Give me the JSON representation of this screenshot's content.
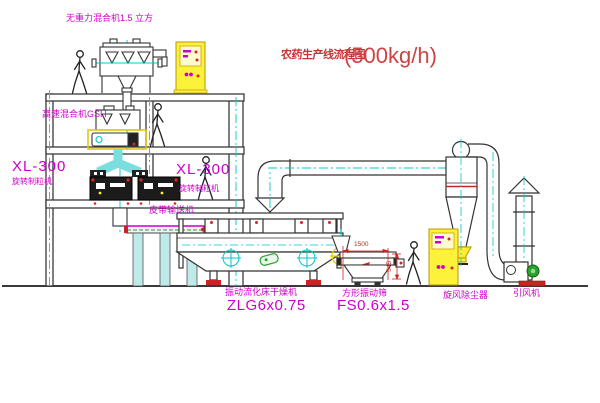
{
  "title": {
    "text": "农药生产线流程图",
    "capacity": "(500kg/h)"
  },
  "equipment_labels": {
    "gravity_mixer": "无重力混合机1.5 立方",
    "high_speed_mixer": "高速混合机GSH",
    "granulator_left_model": "XL-300",
    "granulator_left_name": "旋转制粒机",
    "granulator_mid_model": "XL-300",
    "granulator_mid_name": "旋转制粒机",
    "belt_conveyor": "皮带输送机",
    "fluid_bed_dryer_name": "振动流化床干燥机",
    "fluid_bed_dryer_model": "ZLG6x0.75",
    "square_sieve_name": "方形振动筛",
    "square_sieve_model": "FS0.6x1.5",
    "cyclone": "旋风除尘器",
    "induced_draft_fan": "引风机"
  },
  "dimensions": {
    "sieve_length": "1500",
    "sieve_height": "545"
  },
  "figures": {
    "type": "walking-person",
    "count": 4
  },
  "colors": {
    "label_magenta": "#cc00cc",
    "title_red": "#c43535",
    "dimension_red": "#cc2222",
    "centerline_cyan": "#00c8c8",
    "chute_cyan_fill": "#7adede",
    "cabinet_yellow": "#fdf23a",
    "structure_gray": "#3a3a3a",
    "accent_green": "#2ca02c"
  }
}
